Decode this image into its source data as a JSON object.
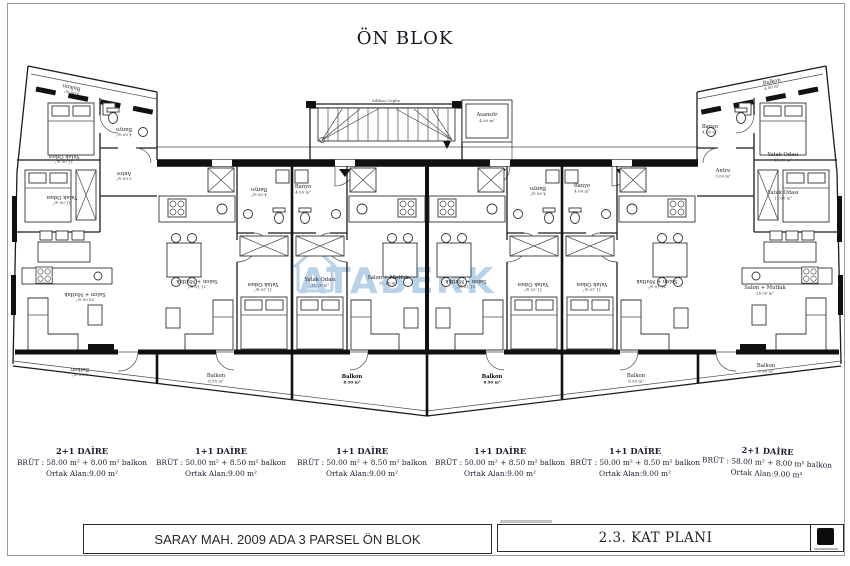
{
  "title": "ÖN BLOK",
  "watermark": "ATABERK",
  "plan": {
    "facade_label": "Silikon Cephe",
    "elevator": {
      "label": "Asansör",
      "area": "4.00 m²"
    },
    "rooms": [
      {
        "label": "Balkon",
        "area": "4.00 m²"
      },
      {
        "label": "Yatak Odası",
        "area": "11.00 m²"
      },
      {
        "label": "Banyo",
        "area": "4.00 m²"
      },
      {
        "label": "Antre",
        "area": "3.00 m²"
      },
      {
        "label": "Yatak Odası",
        "area": "11.00 m²"
      },
      {
        "label": "Salon + Mutfak",
        "area": "26.00 m²"
      },
      {
        "label": "Balkon",
        "area": "8.00 m²"
      },
      {
        "label": "Banyo",
        "area": "4.00 m²"
      },
      {
        "label": "Salon + Mutfak",
        "area": "31.10 m²"
      },
      {
        "label": "Yatak Odası",
        "area": "11.20 m²"
      },
      {
        "label": "Balkon",
        "area": "8.50 m²"
      },
      {
        "label": "Banyo",
        "area": "4.00 m²"
      },
      {
        "label": "Yatak Odası",
        "area": "11.20 m²"
      },
      {
        "label": "Salon + Mutfak",
        "area": "31.10 m²"
      },
      {
        "label": "Balkon",
        "area": "8.50 m²"
      },
      {
        "label": "Banyo",
        "area": "4.00 m²"
      },
      {
        "label": "Salon + Mutfak",
        "area": "31.10 m²"
      },
      {
        "label": "Yatak Odası",
        "area": "11.20 m²"
      },
      {
        "label": "Balkon",
        "area": "8.50 m²"
      },
      {
        "label": "Banyo",
        "area": "4.00 m²"
      },
      {
        "label": "Yatak Odası",
        "area": "11.20 m²"
      },
      {
        "label": "Salon + Mutfak",
        "area": "31.10 m²"
      },
      {
        "label": "Balkon",
        "area": "8.50 m²"
      },
      {
        "label": "Balkon",
        "area": "4.00 m²"
      },
      {
        "label": "Banyo",
        "area": "4.00 m²"
      },
      {
        "label": "Antre",
        "area": "3.00 m²"
      },
      {
        "label": "Yatak Odası",
        "area": "11.00 m²"
      },
      {
        "label": "Yatak Odası",
        "area": "11.00 m²"
      },
      {
        "label": "Salon + Mutfak",
        "area": "26.00 m²"
      },
      {
        "label": "Balkon",
        "area": "8.00 m²"
      }
    ]
  },
  "units": [
    {
      "name": "2+1 DAİRE",
      "brut": "BRÜT : 58.00 m² + 8.00 m² balkon",
      "ortak": "Ortak Alan:9.00 m²"
    },
    {
      "name": "1+1 DAİRE",
      "brut": "BRÜT : 50.00 m² + 8.50 m² balkon",
      "ortak": "Ortak Alan:9.00 m²"
    },
    {
      "name": "1+1 DAİRE",
      "brut": "BRÜT : 50.00 m² + 8.50 m² balkon",
      "ortak": "Ortak Alan:9.00 m²"
    },
    {
      "name": "1+1 DAİRE",
      "brut": "BRÜT : 50.00 m² + 8.50 m² balkon",
      "ortak": "Ortak Alan:9.00 m²"
    },
    {
      "name": "1+1 DAİRE",
      "brut": "BRÜT : 50.00 m² + 8.50 m² balkon",
      "ortak": "Ortak Alan:9.00 m²"
    },
    {
      "name": "2+1 DAİRE",
      "brut": "BRÜT : 58.00 m² + 8.00 m² balkon",
      "ortak": "Ortak Alan:9.00 m²"
    }
  ],
  "titleblock": {
    "project": "SARAY MAH. 2009 ADA 3 PARSEL ÖN BLOK",
    "sheet": "2.3. KAT PLANI"
  },
  "colors": {
    "watermark": "#7fb0d8",
    "line": "#1b1b1b"
  }
}
